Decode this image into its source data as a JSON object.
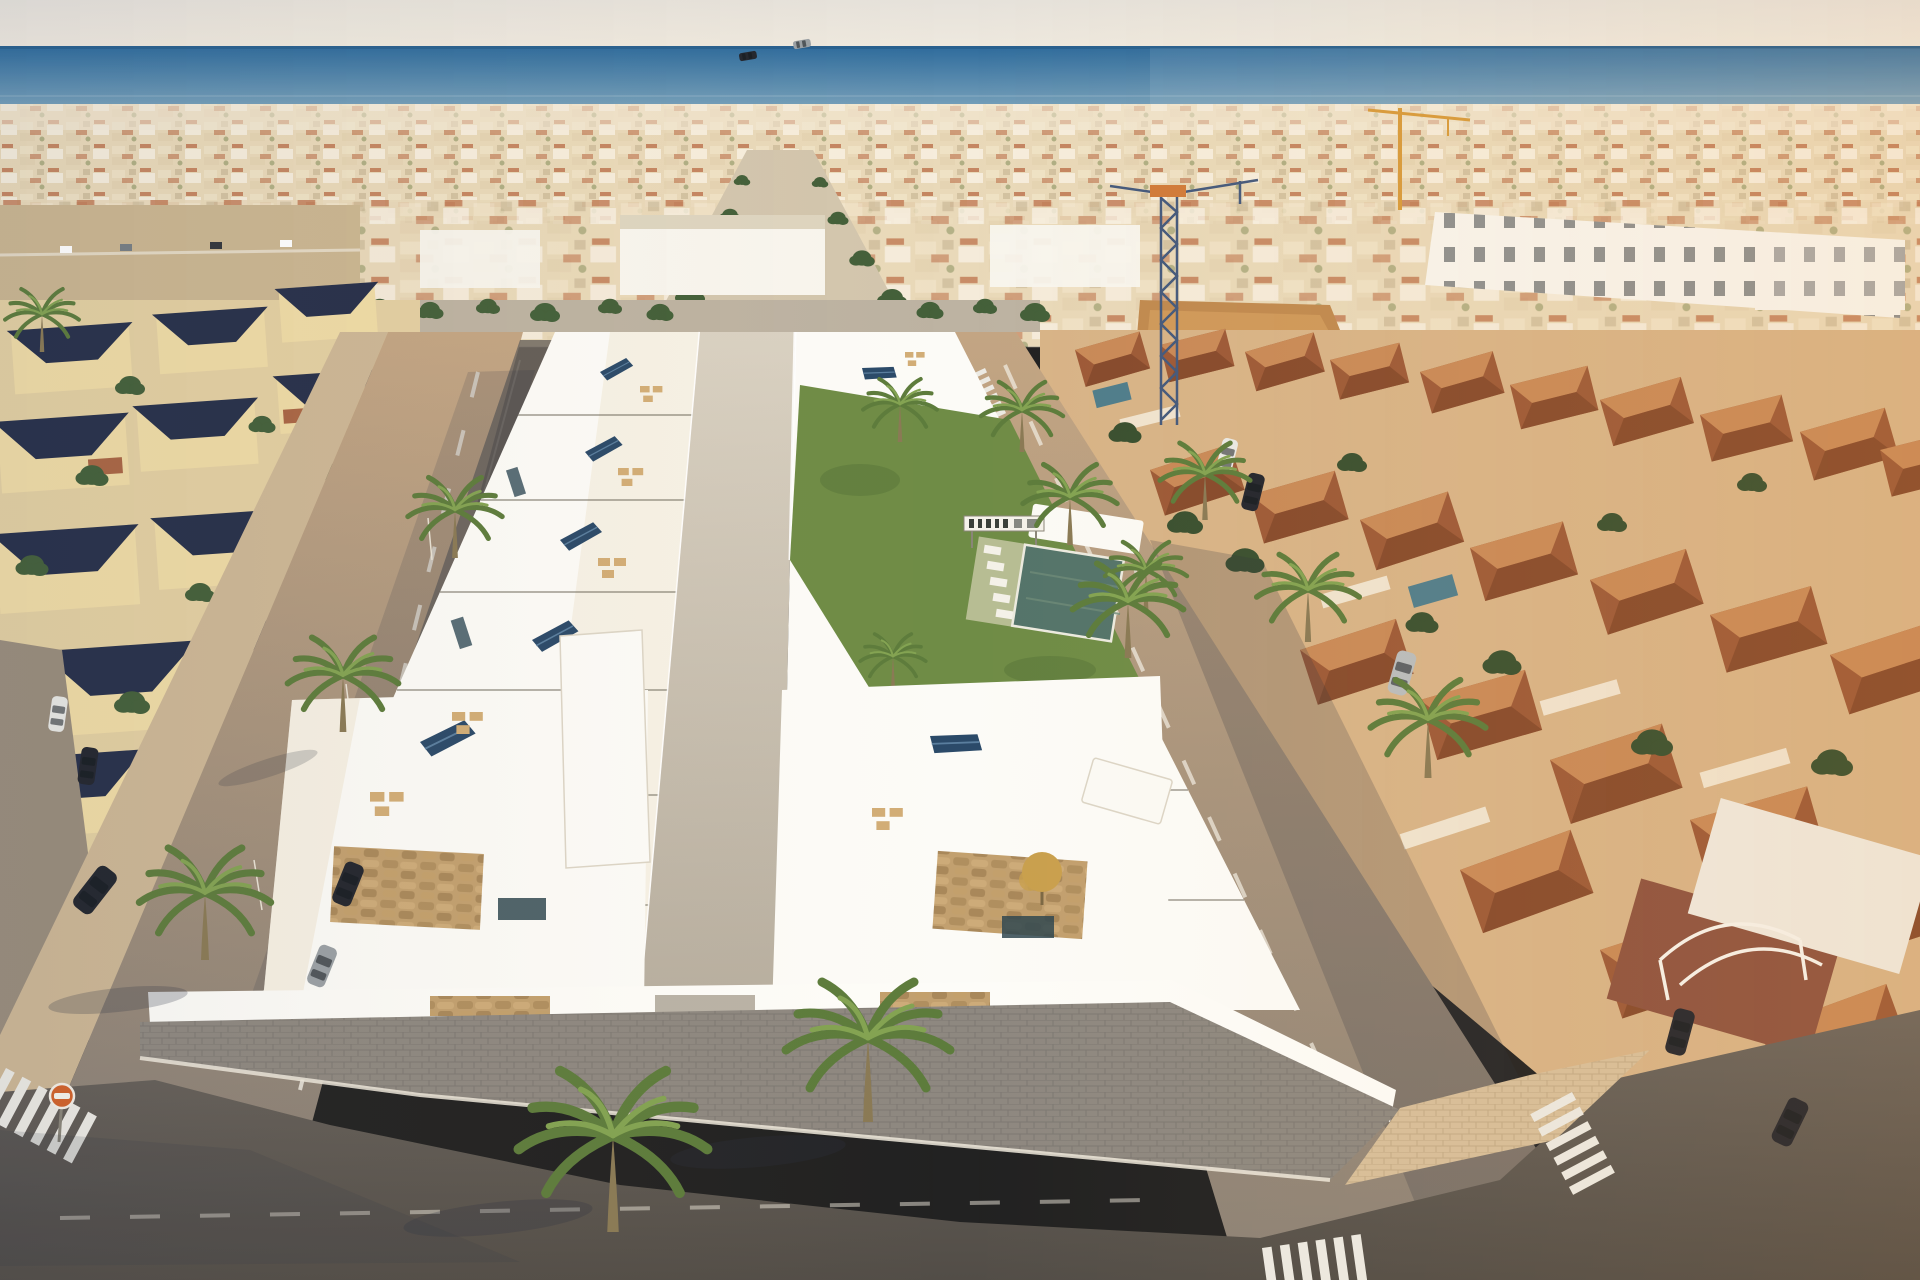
{
  "scene": {
    "type": "aerial-architectural-render",
    "description": "Bird's-eye golden-hour render of a new development of white flat-roof villas with roof terraces and solar panels, set between an older beige-villa neighbourhood (left) and terracotta-roofed townhouses (right), with a communal garden, lettered sign and pool in the centre, palm-lined streets, zebra crossings, parked cars, two construction cranes and the sea on the horizon",
    "sea_on_horizon": true,
    "construction_cranes": 2,
    "communal_pool": true,
    "garden_sign": {
      "present": true,
      "text_legible": false
    },
    "foreground_large_palms": 2,
    "traffic_sign": "orange-circle-sign",
    "zebra_crossings": 4
  },
  "palette": {
    "sky_top": "#e6e2db",
    "sky_bottom": "#f0eadf",
    "sea_deep": "#2e6b9c",
    "sea_light": "#85abc0",
    "city_base": "#e9dcc2",
    "city_white": "#f8f5ee",
    "red_roof": "#b05a38",
    "beige_wall": "#f0dca6",
    "navy_roof": "#27304a",
    "terracotta": "#9d5a38",
    "terracotta_light": "#c98a58",
    "brick": "#8e5340",
    "villa_white": "#fcfbf7",
    "cream": "#efe5cf",
    "solar_navy": "#2b4a69",
    "furniture_tan": "#d2ad76",
    "grass": "#6f8c46",
    "palm_green": "#5d7c3c",
    "palm_light": "#83a352",
    "trunk": "#8a7a55",
    "pool_green": "#54746a",
    "pool_small": "#4f7d8c",
    "street_warm": "#c3a583",
    "street_grey": "#8b8176",
    "road_dark": "#5e5851",
    "paver_grey": "#8e8880",
    "sidewalk_beige": "#d7bf9b",
    "wall_white": "#fdfcf8",
    "stone": "#c2a06f",
    "crane_blue": "#44597c",
    "crane_yellow": "#d79b3c",
    "car_dark": "#23262e",
    "car_grey": "#9aa0a4",
    "car_white": "#e9e9e5",
    "car_silver": "#b9bdbe",
    "sign_orange": "#d2622a",
    "shadow": "#2e3442"
  }
}
